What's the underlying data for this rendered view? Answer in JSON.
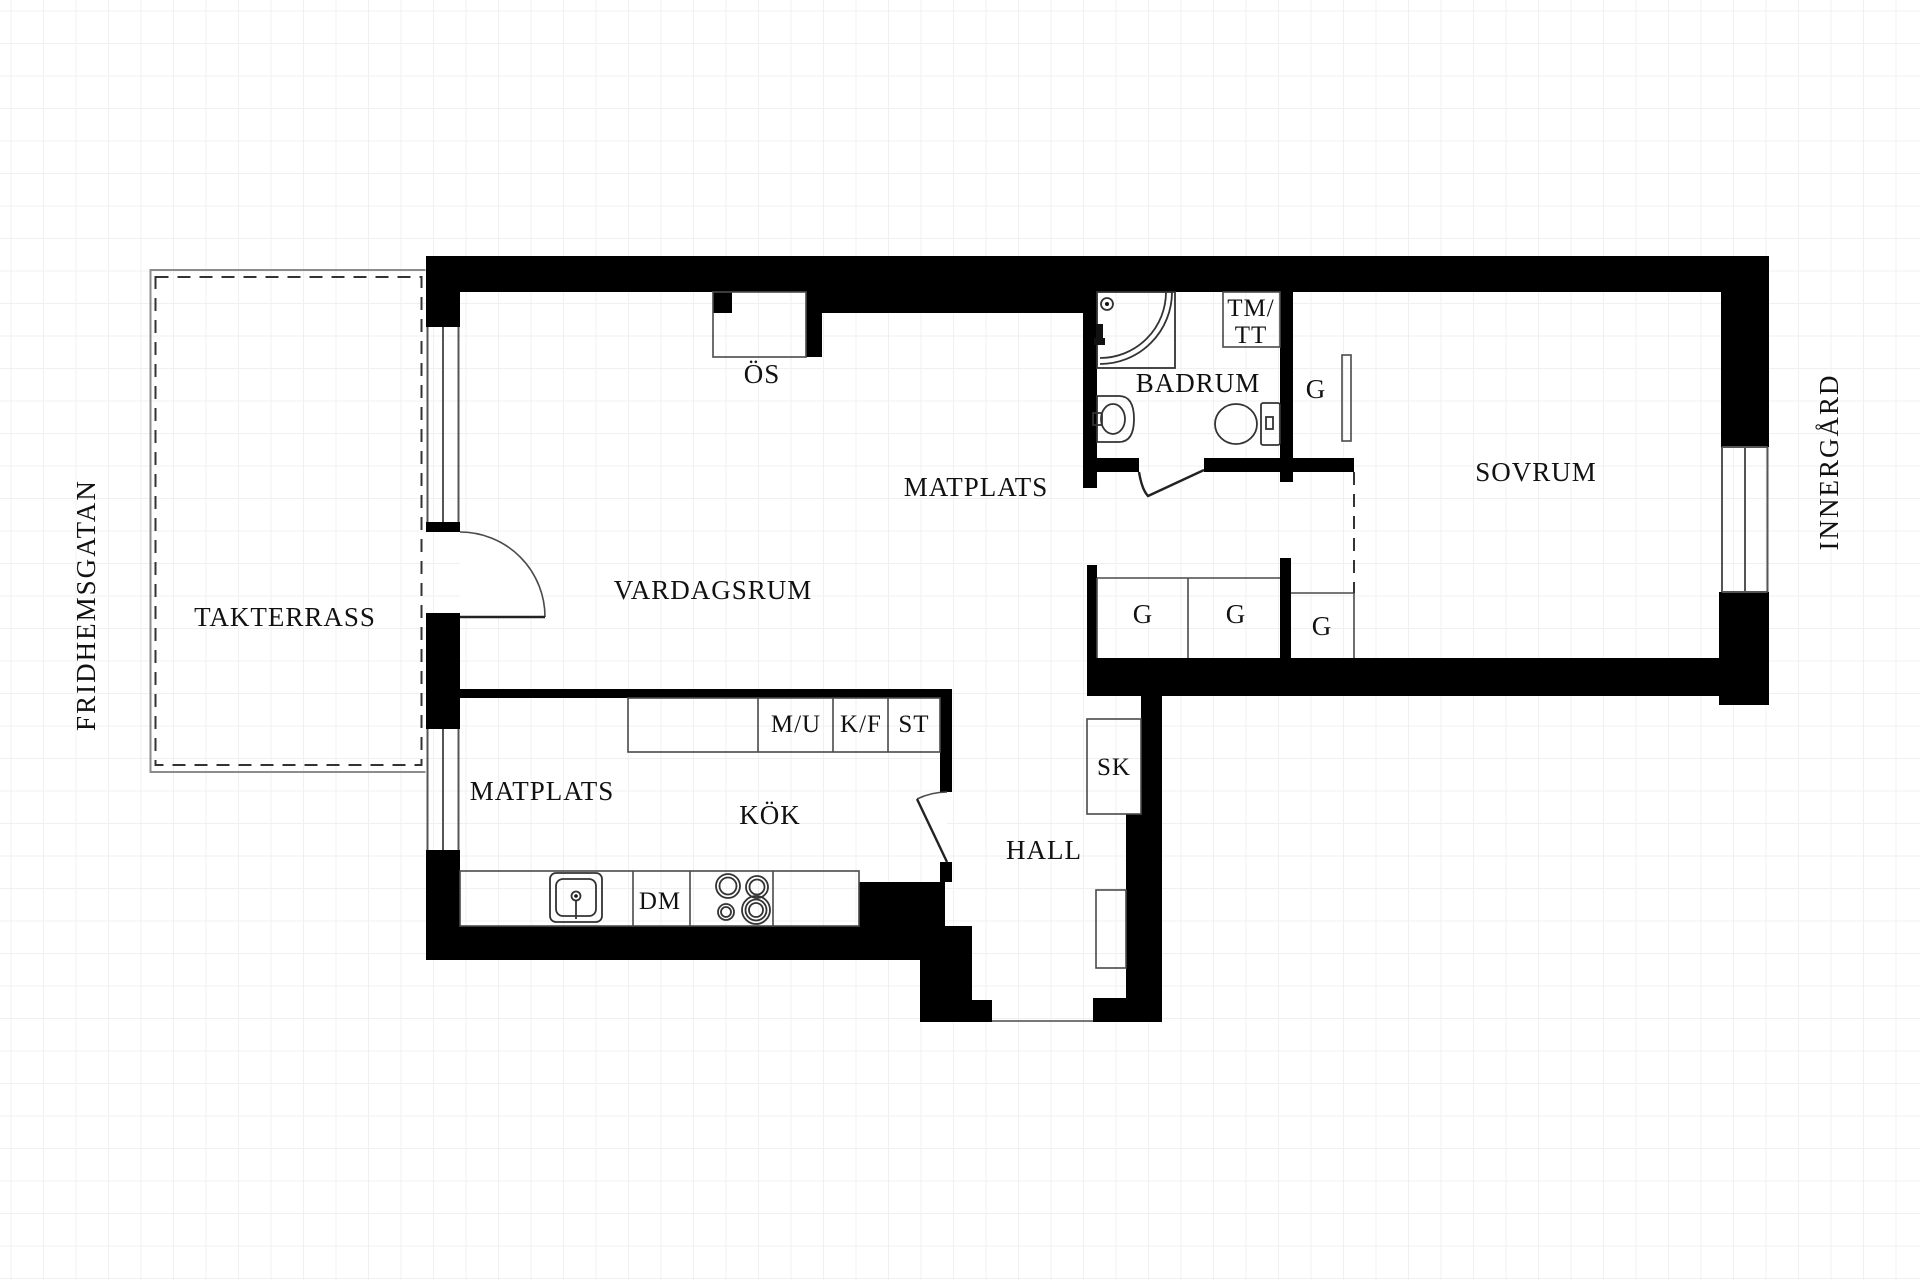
{
  "surroundings": {
    "street_left": "FRIDHEMSGATAN",
    "courtyard_right": "INNERGÅRD"
  },
  "rooms": {
    "terrace": "TAKTERRASS",
    "living_room": "VARDAGSRUM",
    "dining_upper": "MATPLATS",
    "bathroom": "BADRUM",
    "bedroom": "SOVRUM",
    "kitchen": "KÖK",
    "dining_kitchen": "MATPLATS",
    "hall": "HALL"
  },
  "fixtures": {
    "fireplace": "ÖS",
    "washer_dryer_line1": "TM/",
    "washer_dryer_line2": "TT",
    "wardrobe": "G",
    "cleaning_closet": "SK",
    "micro_oven": "M/U",
    "fridge_freezer": "K/F",
    "pantry": "ST",
    "dishwasher": "DM"
  },
  "colors": {
    "wall": "#000000",
    "line": "#4a4a4a",
    "grid": "#f0f0f0",
    "background": "#ffffff",
    "text": "#111111"
  }
}
